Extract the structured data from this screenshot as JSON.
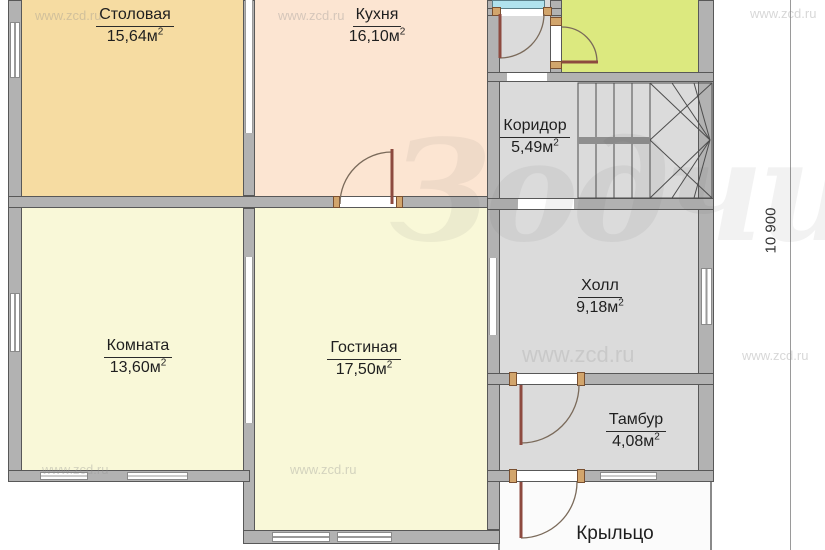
{
  "plan": {
    "sup": "2",
    "dimension_right": "10 900",
    "rooms": {
      "stolovaya": {
        "name": "Столовая",
        "area": "15,64м",
        "color": "#f6dca2"
      },
      "kuhnya": {
        "name": "Кухня",
        "area": "16,10м",
        "color": "#fce5d2"
      },
      "koridor": {
        "name": "Коридор",
        "area": "5,49м",
        "color": "#dbdbdb"
      },
      "holl": {
        "name": "Холл",
        "area": "9,18м",
        "color": "#dbdbdb"
      },
      "komnata": {
        "name": "Комната",
        "area": "13,60м",
        "color": "#f9f8d8"
      },
      "gostinaya": {
        "name": "Гостиная",
        "area": "17,50м",
        "color": "#f9f8d8"
      },
      "tambur": {
        "name": "Тамбур",
        "area": "4,08м",
        "color": "#dbdbdb"
      },
      "kryltso": {
        "name": "Крыльцо",
        "color": "#fbfbfb"
      },
      "green_room": {
        "color": "#dce97f"
      },
      "cyan_strip": {
        "color": "#b0e2ee"
      }
    },
    "watermarks": {
      "site": "www.zcd.ru",
      "logo": "Зодчий"
    },
    "colors": {
      "wall": "#b2b2b2",
      "wall_edge": "#585858",
      "door_leaf": "#8d4a3f"
    }
  }
}
